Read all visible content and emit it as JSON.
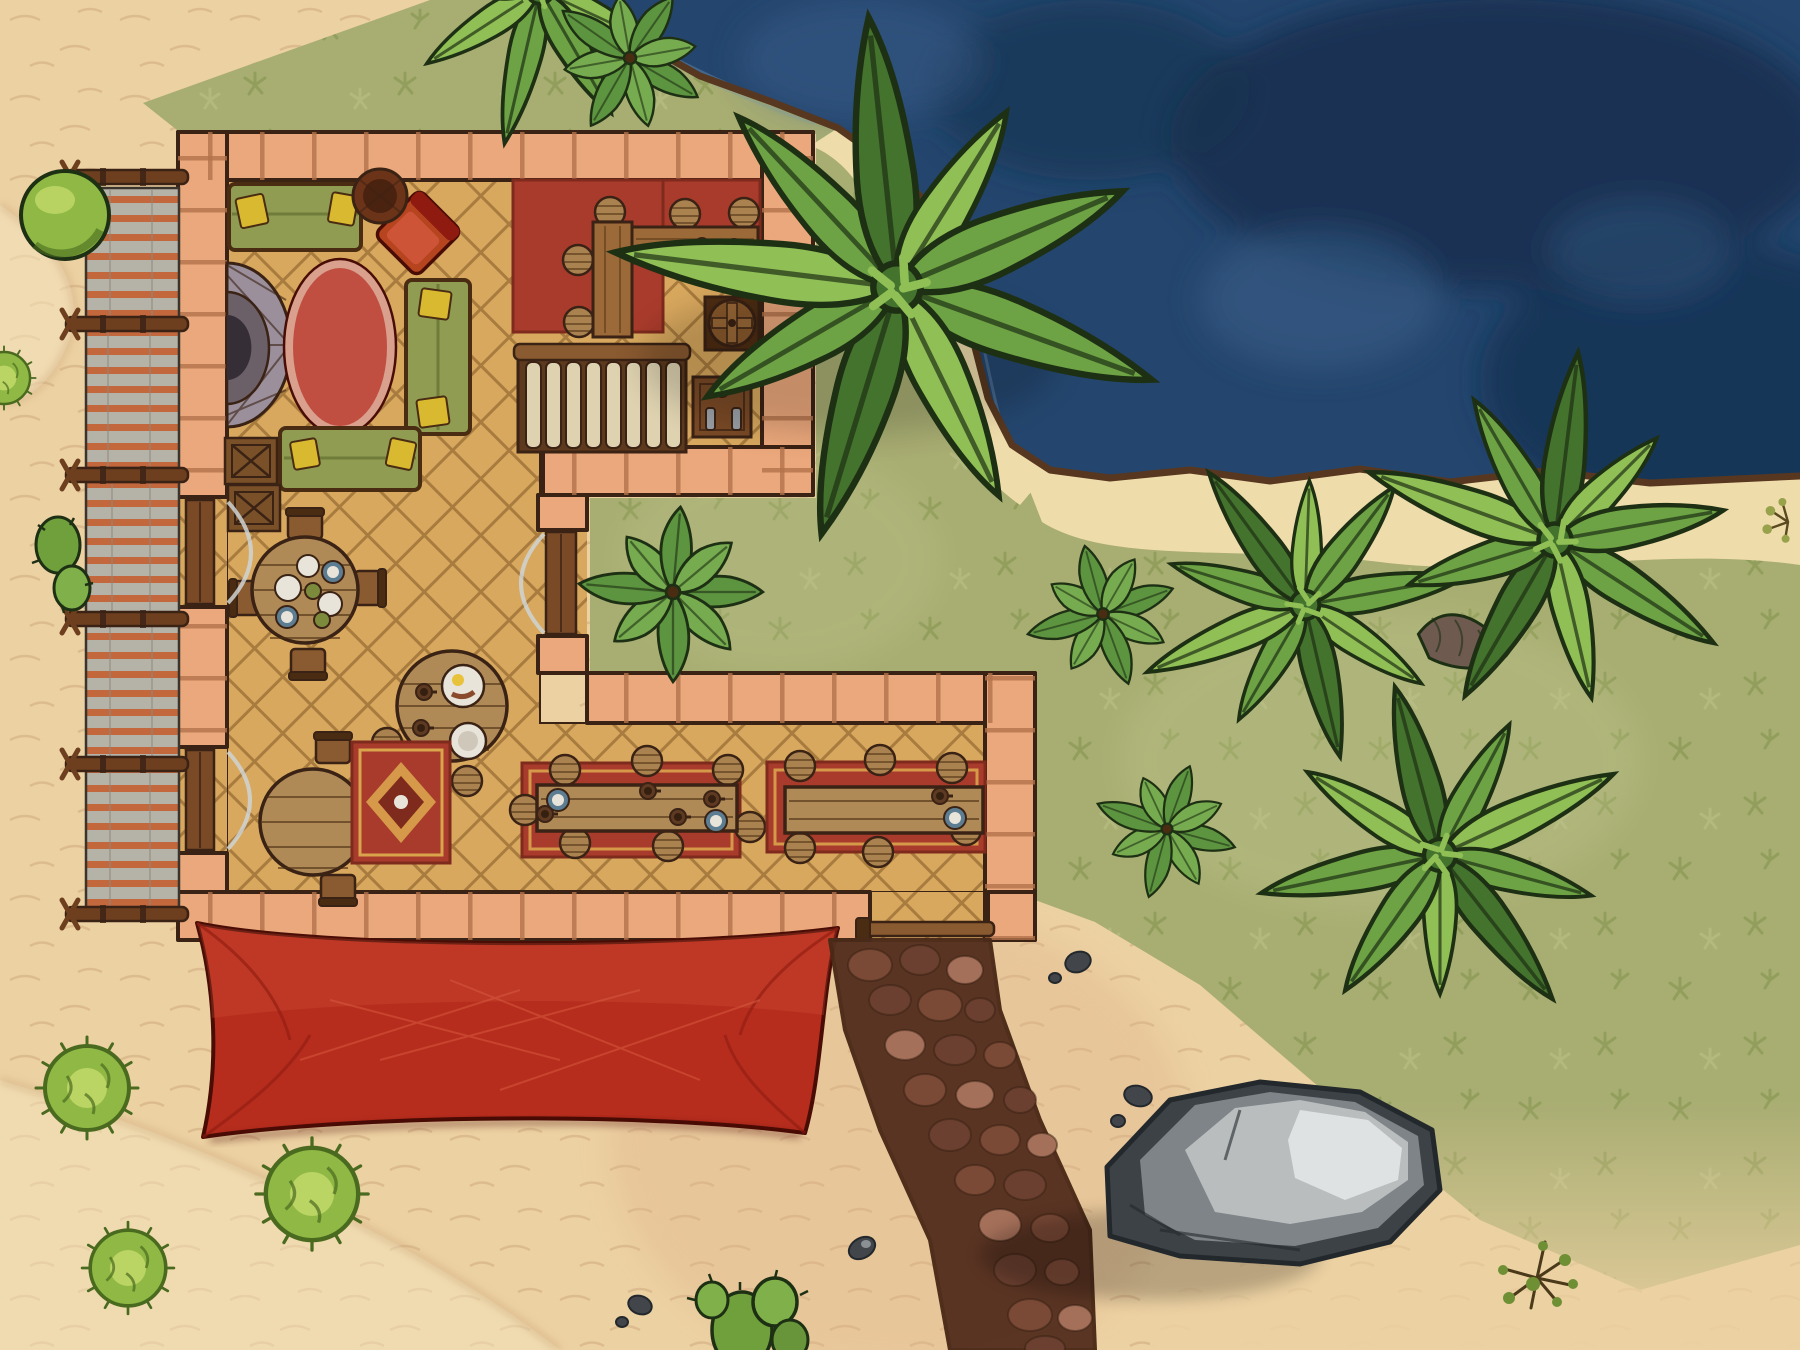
{
  "map": {
    "kind": "top-down fantasy battlemap",
    "scene": "beachside tavern with dock awning, courtyard, palm trees and ocean",
    "features": [
      "ocean-water",
      "beach-sand",
      "grass-field",
      "stone-tavern-walls",
      "herringbone-floor",
      "striped-dock-awning",
      "red-canvas-awning",
      "cobblestone-path",
      "grey-boulder",
      "palm-trees",
      "leafy-shrubs",
      "round-spiky-bushes",
      "cacti",
      "fireplace-hearth",
      "green-couches",
      "red-armchair",
      "oval-red-rug",
      "ornate-rug",
      "bar-counter-with-stools",
      "wooden-staircase",
      "storage-barrel",
      "storage-crates",
      "round-dining-tables",
      "long-feast-tables-with-runner-rugs",
      "wooden-doors",
      "pebbles",
      "grass-tufts"
    ]
  },
  "palette": {
    "sand": "#ecd1a2",
    "sandLight": "#f6e6c2",
    "sandShade": "#c9a378",
    "sandPink": "#dfb28a",
    "grass": "#a8ad72",
    "grassDark": "#7f9149",
    "grassLight": "#c2c98f",
    "water": "#24466e",
    "waterDark": "#16304f",
    "waterLight": "#3c608b",
    "ripple": "#7396b6",
    "shoreLine": "#57371f",
    "shoreSand": "#efdcab",
    "wall": "#eba87c",
    "wallSeam": "#b3714a",
    "wallDark": "#3a2214",
    "floorTan": "#d8a85e",
    "floorGap": "#a87b3e",
    "counterWood": "#9c6a38",
    "tableWood": "#b08a56",
    "woodDark": "#4a2c12",
    "couchGreen": "#8f9c52",
    "couchDark": "#6f7c3a",
    "pillowYellow": "#d9b92f",
    "rugSalmon": "#c14f41",
    "rugSalmonLight": "#daa08e",
    "rugRed": "#a93b2c",
    "rugGold": "#d9a44c",
    "rugDark": "#7e2a1c",
    "tentRed": "#b62d1d",
    "tentDark": "#8e1a10",
    "tentLight": "#d95b41",
    "tentOutline": "#4a0d06",
    "canvasGrey": "#b5b2a8",
    "canvasDark": "#8e8a80",
    "stripeOrange": "#c55f31",
    "dockWood": "#6e3f1e",
    "pathBase": "#55301f",
    "cobbleA": "#7b4a37",
    "cobbleB": "#6b4030",
    "cobbleHi": "#a5705a",
    "rockDark": "#3c4246",
    "rockMid": "#7e8487",
    "rockLight": "#b9bdbe",
    "rockHi": "#dfe2e2",
    "palmDark": "#44732e",
    "palmMid": "#6da344",
    "palmLight": "#8fbf55",
    "leafOutline": "#1e3014",
    "shrubGreen": "#5d9440",
    "shrubLight": "#76ab4f",
    "bushGreen": "#8fb944",
    "bushLight": "#c3d96a",
    "bushDark": "#4a6a1f",
    "trunkBrown": "#6f5a50",
    "hearthOuter": "#9b8f9b",
    "hearthMid": "#6b5f68",
    "hearthInner": "#352e36",
    "plateWhite": "#e8e4da",
    "plateBlue": "#5c7d92",
    "mugBrown": "#5f3a22",
    "mugDark": "#35200f",
    "eggYellow": "#e8c23a",
    "stoolWood": "#a9824f",
    "plankCream": "#ded2b0",
    "pebble": "#42464a",
    "doorWood": "#7a4a26",
    "chairRed": "#b5441f"
  }
}
